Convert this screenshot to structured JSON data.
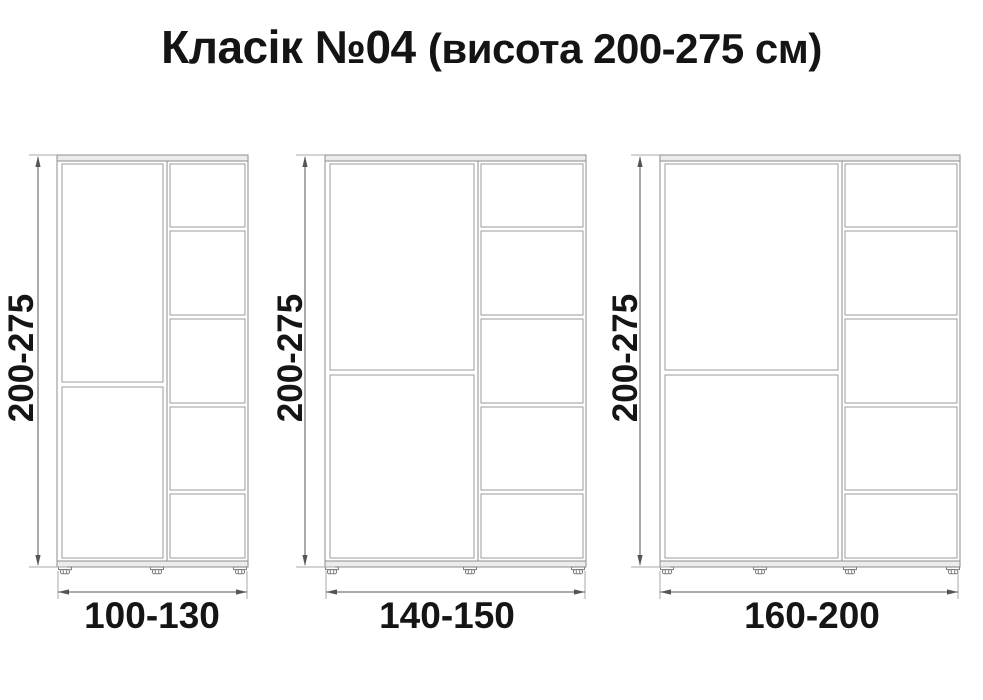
{
  "title": {
    "main": "Класік №04",
    "subtitle": "(висота 200-275 см)"
  },
  "colors": {
    "background": "#ffffff",
    "cabinet_line": "#8d8d8d",
    "dimension_line": "#555555",
    "text": "#141414"
  },
  "cabinets": [
    {
      "height_label": "200-275",
      "width_label": "100-130",
      "door_sections": 2,
      "shelf_compartments": 5,
      "feet_count": 3
    },
    {
      "height_label": "200-275",
      "width_label": "140-150",
      "door_sections": 2,
      "shelf_compartments": 5,
      "feet_count": 3
    },
    {
      "height_label": "200-275",
      "width_label": "160-200",
      "door_sections": 2,
      "shelf_compartments": 5,
      "feet_count": 4
    }
  ]
}
